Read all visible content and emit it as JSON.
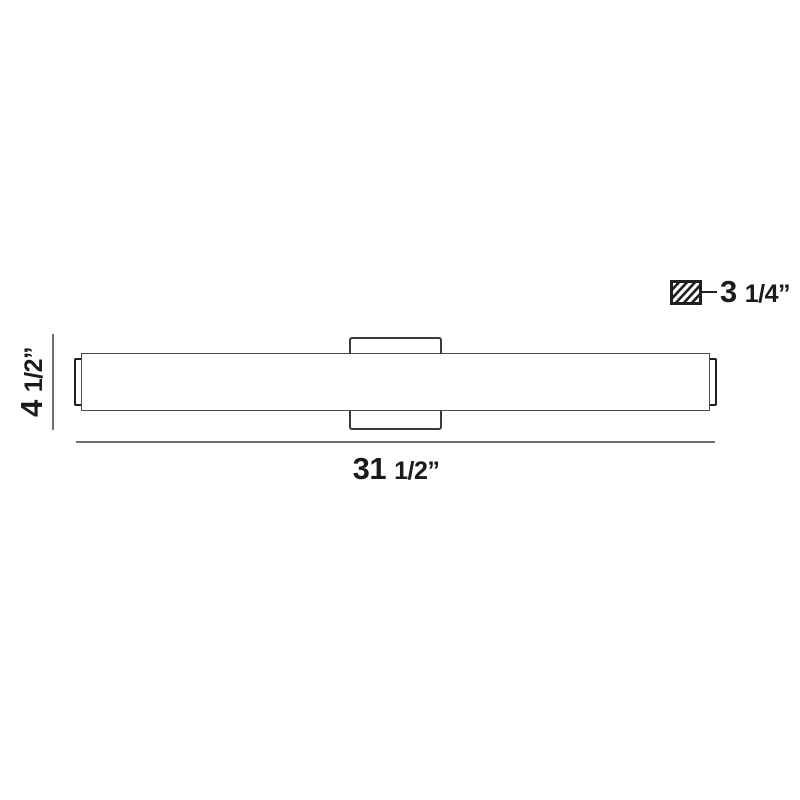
{
  "drawing": {
    "dimensions": {
      "height": {
        "whole": "4",
        "fraction": "1/2”"
      },
      "width": {
        "whole": "31",
        "fraction": "1/2”"
      },
      "depth": {
        "whole": "3",
        "fraction": "1/4”"
      }
    },
    "icons": {
      "depth_symbol": "diagonal-hatch-swatch"
    }
  },
  "colors": {
    "background": "#ffffff",
    "outline": "#4a4a4a",
    "outline_dark": "#1f1f1f",
    "plate_outline": "#3a3a3a",
    "dim_line": "#6f6f6f",
    "text": "#1b1b1b"
  }
}
